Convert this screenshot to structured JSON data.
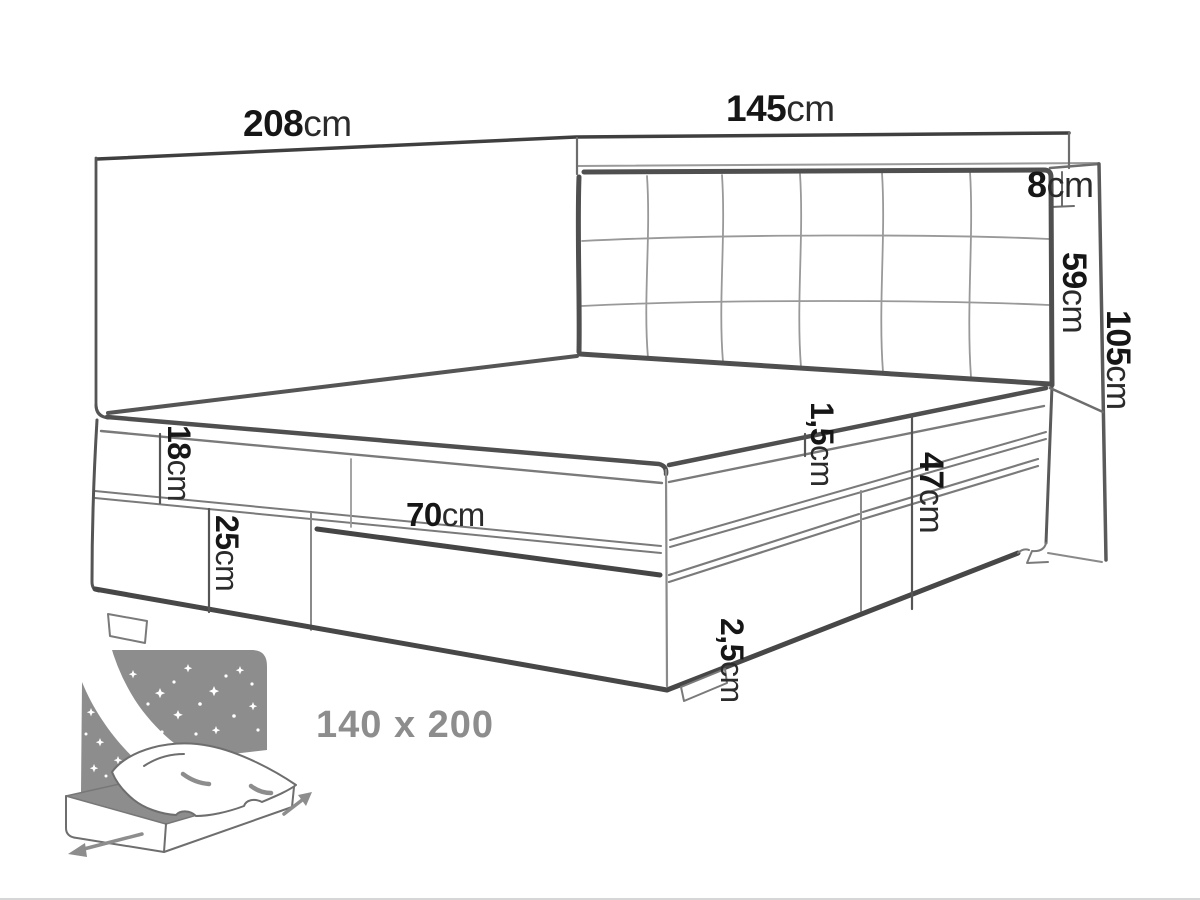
{
  "figure": {
    "title": "bed-dimension-diagram",
    "size_label": "140 x 200",
    "dimensions": [
      {
        "id": "wall-panel-width",
        "value": "208",
        "unit": "cm"
      },
      {
        "id": "headboard-width",
        "value": "145",
        "unit": "cm"
      },
      {
        "id": "headboard-depth",
        "value": "8",
        "unit": "cm"
      },
      {
        "id": "headboard-height",
        "value": "59",
        "unit": "cm"
      },
      {
        "id": "panel-total-height",
        "value": "105",
        "unit": "cm"
      },
      {
        "id": "mattress-height",
        "value": "18",
        "unit": "cm"
      },
      {
        "id": "base-height",
        "value": "25",
        "unit": "cm"
      },
      {
        "id": "drawer-width",
        "value": "70",
        "unit": "cm"
      },
      {
        "id": "topper-gap",
        "value": "1,5",
        "unit": "cm"
      },
      {
        "id": "side-height",
        "value": "47",
        "unit": "cm"
      },
      {
        "id": "foot-height",
        "value": "2,5",
        "unit": "cm"
      }
    ],
    "colors": {
      "line_dark": "#474747",
      "line_mid": "#6d6d6d",
      "line_light": "#9a9a9a",
      "label": "#161616",
      "muted_gray": "#8d8d8d",
      "background": "#ffffff"
    }
  }
}
